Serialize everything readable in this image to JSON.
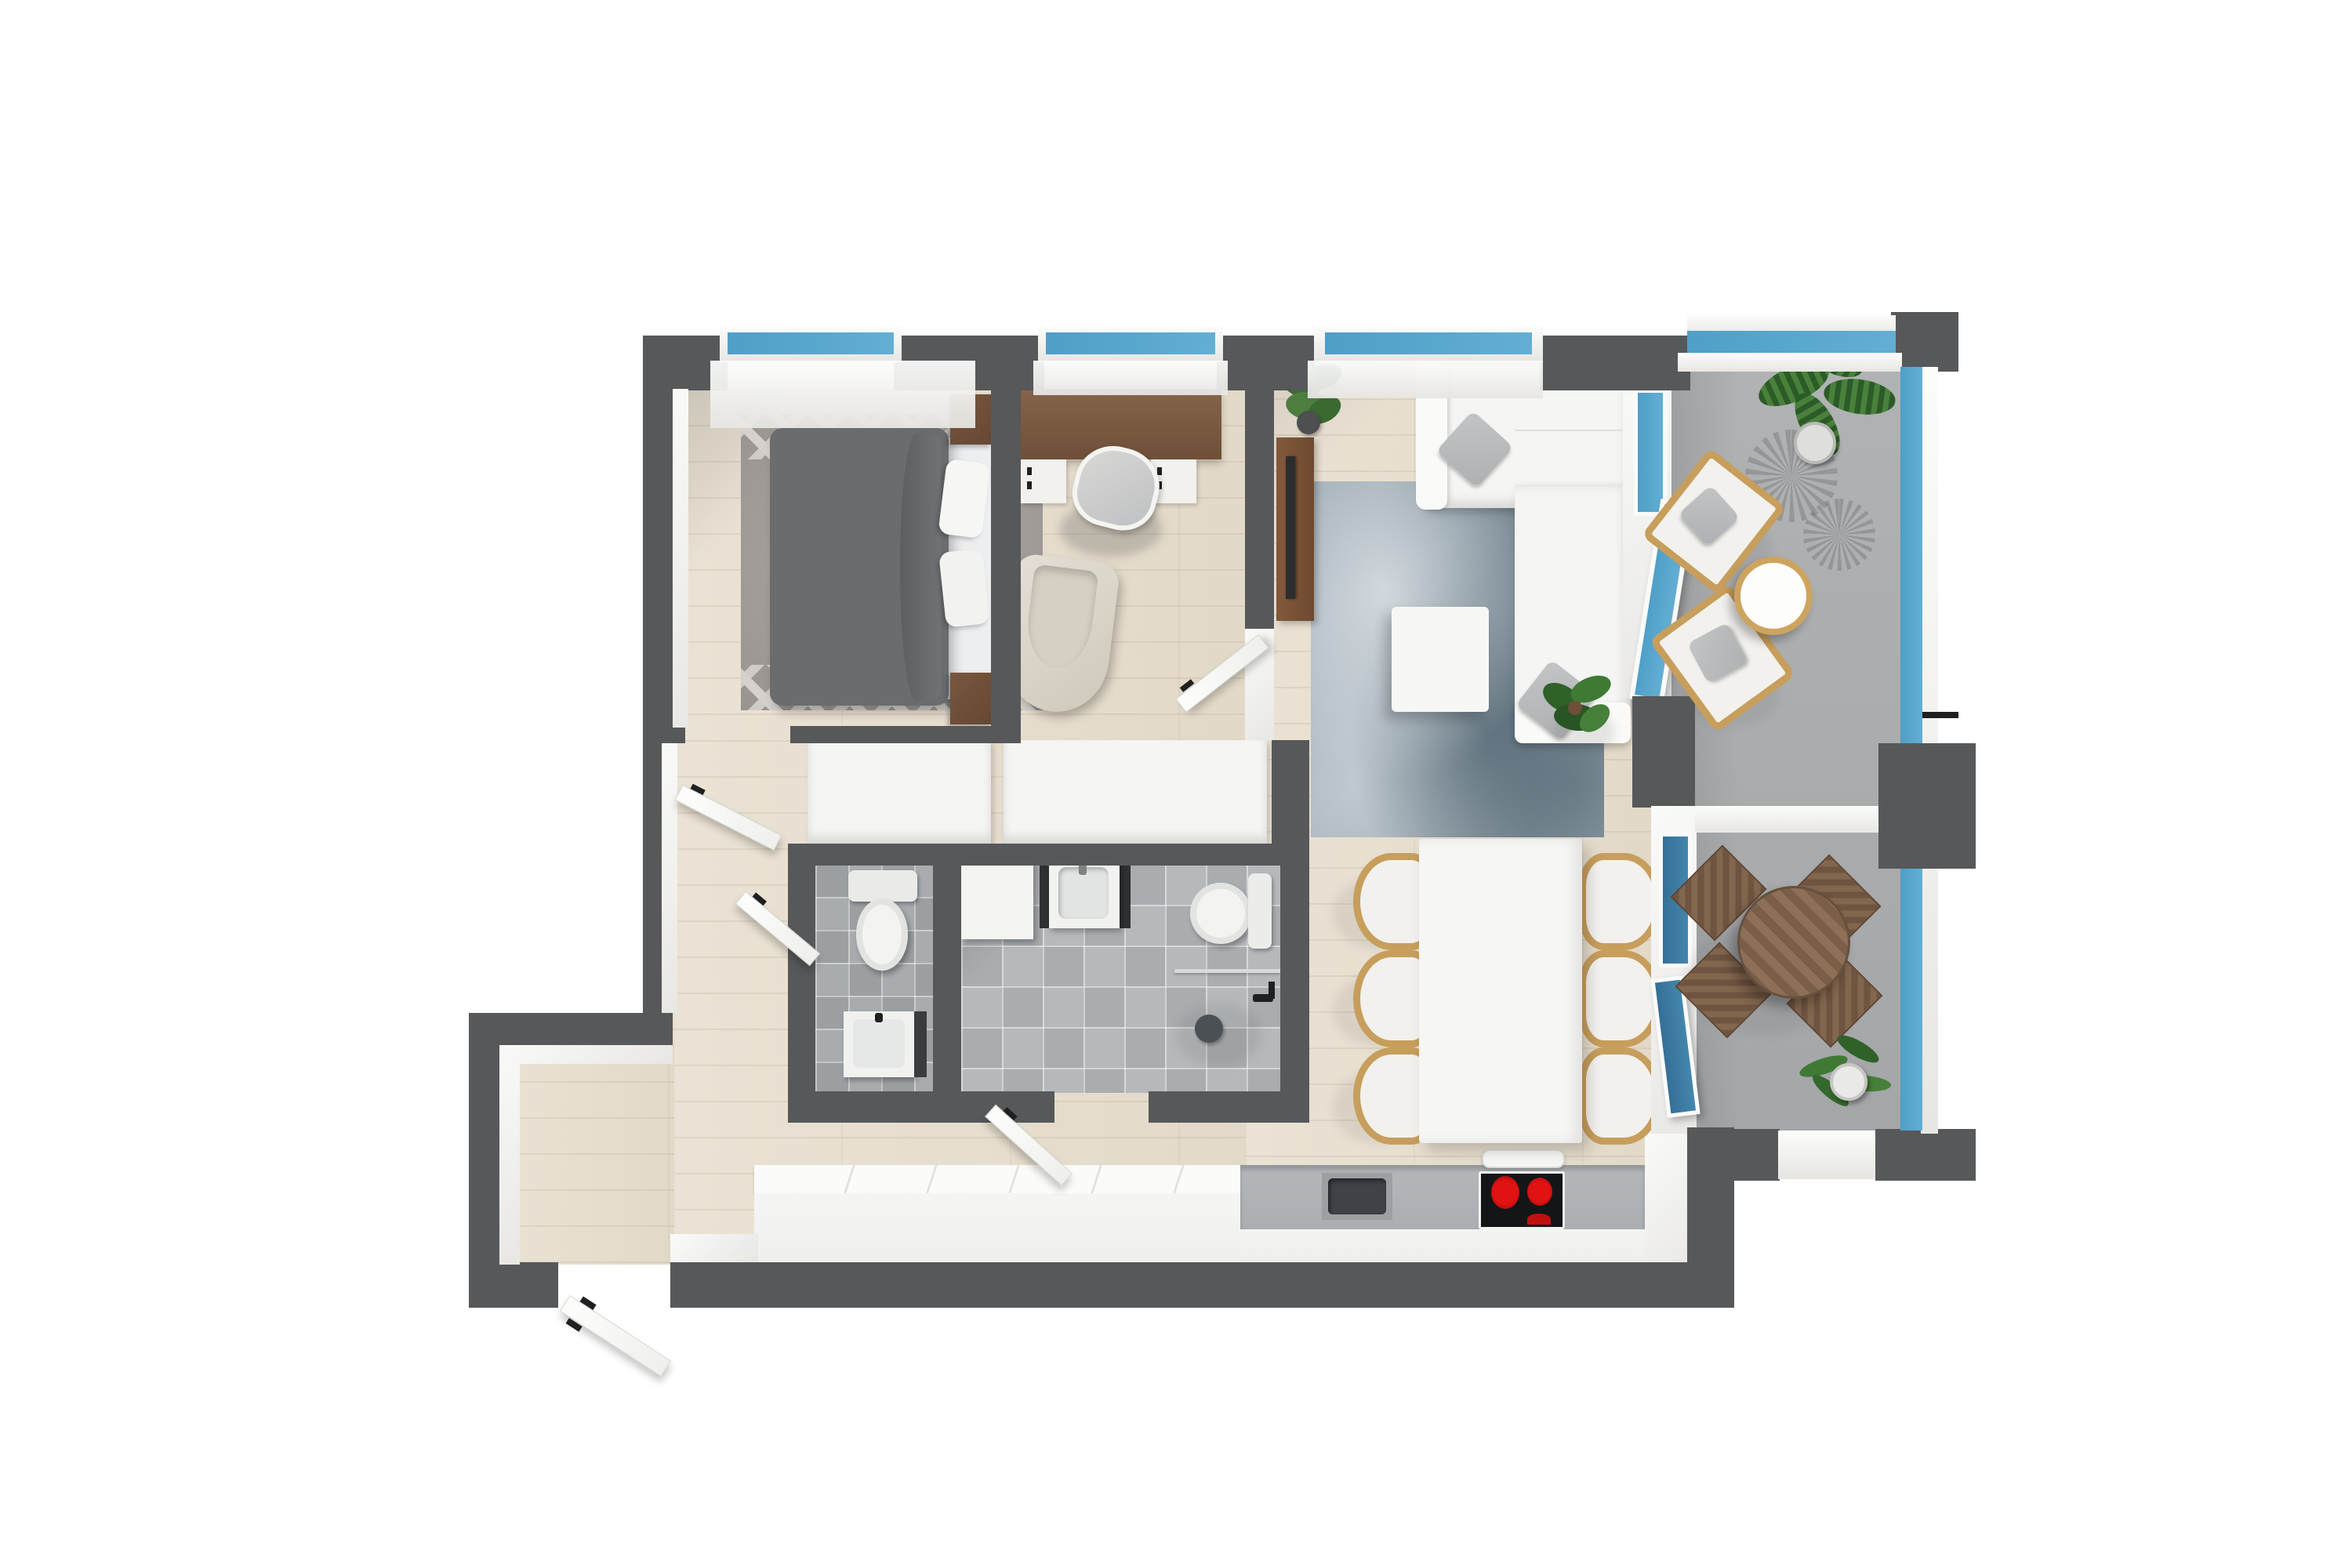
{
  "scene": {
    "type": "3d-floor-plan-render",
    "view": "top-down",
    "title": "Apartment 3D floor plan",
    "background": "#ffffff"
  },
  "palette": {
    "wall": "#57585a",
    "wall_face": "#f1f0ee",
    "wood_floor": "#e7dfd1",
    "tile_floor": "#b4b7ba",
    "balcony_floor": "#a8aaac",
    "window_glass": "#4f9fc8",
    "balustrade_glass": "#63aed3",
    "door_glass_deep": "#3a7ba3",
    "furniture_white": "#f5f5f3",
    "cushion_gray": "#b5b7b9",
    "walnut": "#7b5a41",
    "rattan": "#c79e5c",
    "outdoor_wood": "#7d604a",
    "burner_red": "#c01010",
    "plant_green": "#3f7a35"
  },
  "rooms": {
    "bedroom": {
      "label": "Bedroom",
      "furniture": [
        "double bed with gray duvet",
        "white mattress pillows",
        "gray zigzag area rug",
        "walnut nightstand (top)",
        "walnut nightstand (bottom)",
        "window",
        "white door (open)"
      ]
    },
    "office": {
      "label": "Home office",
      "furniture": [
        "walnut desk",
        "drawer unit left",
        "drawer unit right",
        "swivel desk chair",
        "beige U-shaped lounge chair",
        "window",
        "white door (open)"
      ]
    },
    "living_room": {
      "label": "Living room",
      "furniture": [
        "white corner sofa",
        "gray sofa cushion (top)",
        "gray sofa cushion (bottom)",
        "white coffee table",
        "blue-gray mottled rug",
        "walnut media console with TV",
        "potted plant (corner)",
        "floor plant (by sofa)",
        "window",
        "glass balcony door (open)"
      ]
    },
    "dining_area": {
      "label": "Dining area",
      "furniture": [
        "white rectangular dining table",
        "six rattan wishbone chairs",
        "glass balcony doors"
      ]
    },
    "kitchen": {
      "label": "Kitchen",
      "furniture": [
        "white cabinet run",
        "gray countertop",
        "undermount sink",
        "black cooktop with red burners",
        "range hood"
      ]
    },
    "hallway": {
      "label": "Hallway / entry",
      "furniture": [
        "white wardrobe (left)",
        "white wardrobe (right)",
        "entry door (open)",
        "entry alcove"
      ]
    },
    "wc": {
      "label": "Guest WC",
      "furniture": [
        "toilet",
        "washbasin"
      ]
    },
    "bathroom": {
      "label": "Bathroom",
      "furniture": [
        "washing machine",
        "vanity washbasin",
        "toilet",
        "walk-in shower with glass screen",
        "white door (open)"
      ]
    },
    "balcony_lounge": {
      "label": "Balcony - lounge end",
      "furniture": [
        "rattan armchair (upper)",
        "rattan armchair (lower)",
        "round side table",
        "fan palm in pot",
        "glass balustrade"
      ]
    },
    "balcony_dining": {
      "label": "Balcony - dining end",
      "furniture": [
        "round slatted wood table",
        "four folding wood chairs",
        "potted palm",
        "glass balustrade"
      ]
    }
  }
}
